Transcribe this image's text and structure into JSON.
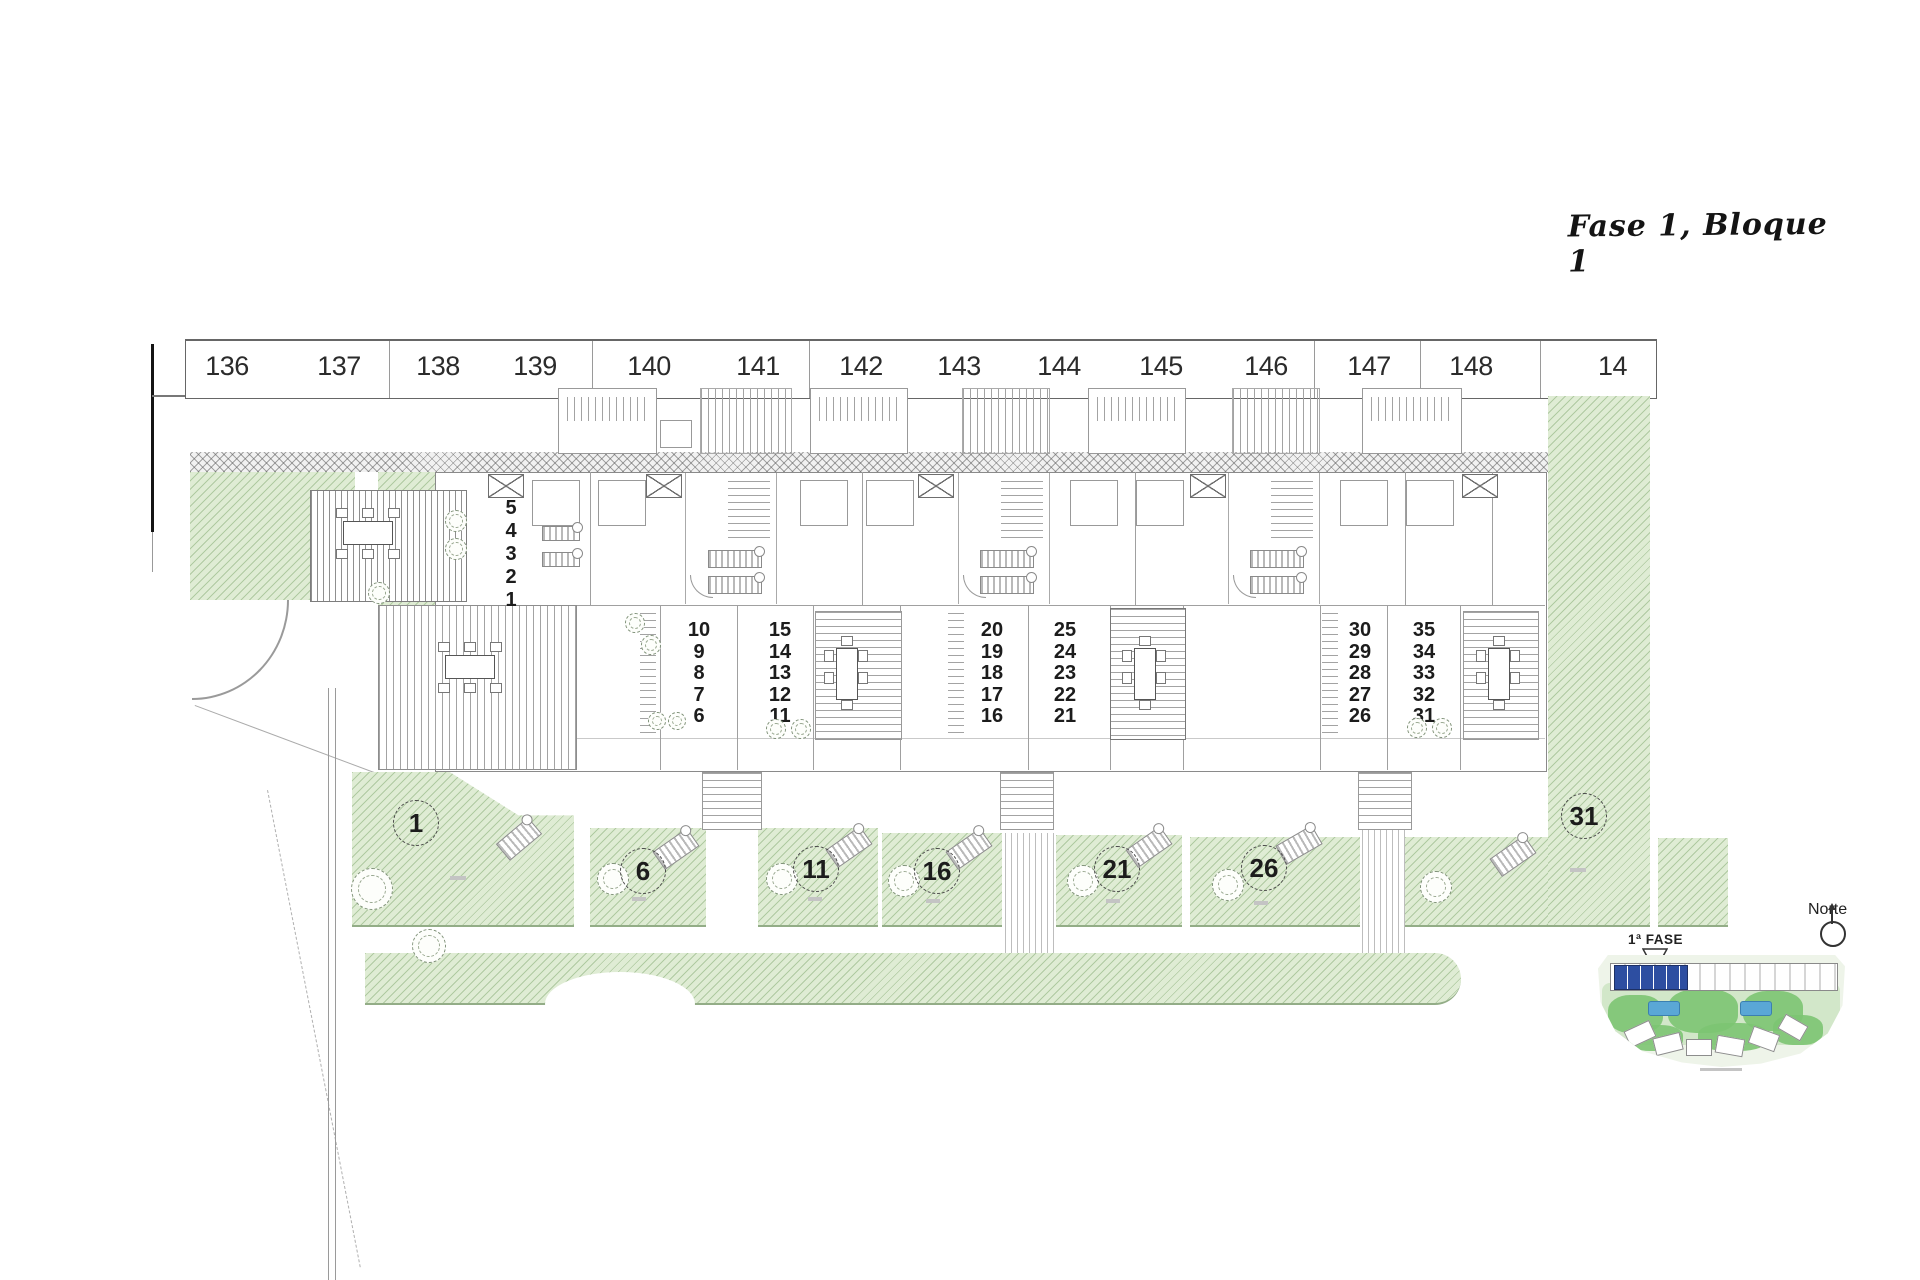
{
  "title": {
    "text": "Fase 1, Bloque 1"
  },
  "parking_row": {
    "spaces": [
      "136",
      "137",
      "138",
      "139",
      "140",
      "141",
      "142",
      "143",
      "144",
      "145",
      "146",
      "147",
      "148",
      "14"
    ]
  },
  "building": {
    "unit_stacks": [
      {
        "numbers": [
          "5",
          "4",
          "3",
          "2",
          "1"
        ]
      },
      {
        "numbers": [
          "10",
          "9",
          "8",
          "7",
          "6"
        ]
      },
      {
        "numbers": [
          "15",
          "14",
          "13",
          "12",
          "11"
        ]
      },
      {
        "numbers": [
          "20",
          "19",
          "18",
          "17",
          "16"
        ]
      },
      {
        "numbers": [
          "25",
          "24",
          "23",
          "22",
          "21"
        ]
      },
      {
        "numbers": [
          "30",
          "29",
          "28",
          "27",
          "26"
        ]
      },
      {
        "numbers": [
          "35",
          "34",
          "33",
          "32",
          "31"
        ]
      }
    ]
  },
  "gardens": {
    "plot_labels": [
      "1",
      "6",
      "11",
      "16",
      "21",
      "26",
      "31"
    ]
  },
  "minimap": {
    "phase_label": "1ª FASE",
    "north_label": "Norte"
  },
  "colors": {
    "garden_green": "#dfecd4",
    "hatch_green": "#86a973",
    "plan_line": "#8a8a8a",
    "phase_blue": "#2d4ea1",
    "pool_blue": "#5aa7d6"
  }
}
